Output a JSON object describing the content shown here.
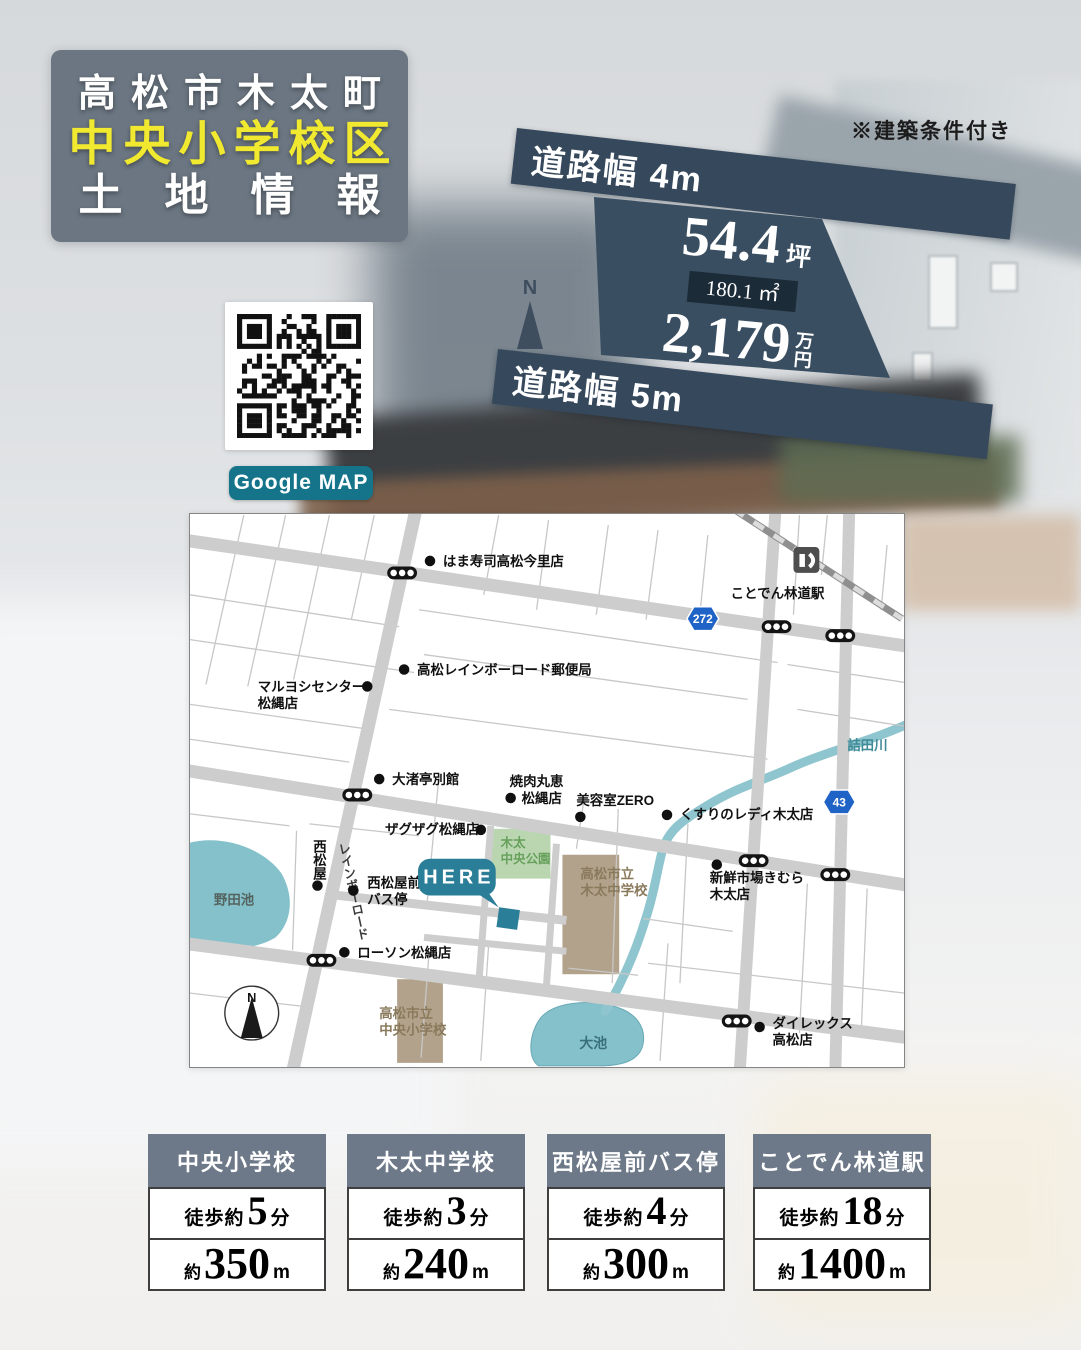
{
  "title_block": {
    "line1": "高松市木太町",
    "line2": "中央小学校区",
    "line3": "土地情報"
  },
  "note": "※建築条件付き",
  "banners": {
    "top": "道路幅 4m",
    "bottom": "道路幅 5m"
  },
  "parcel": {
    "tsubo": "54.4",
    "tsubo_unit": "坪",
    "area": "180.1 ㎡",
    "price": "2,179",
    "price_unit_top": "万",
    "price_unit_bottom": "円"
  },
  "compass_upper": {
    "label": "N"
  },
  "qr": {
    "caption": "Google MAP"
  },
  "map": {
    "compass_label": "N",
    "here_label": "HERE",
    "pois": [
      {
        "id": "hamazushi",
        "lines": [
          "はま寿司高松今里店"
        ],
        "x": 254,
        "y": 51,
        "dot": [
          241,
          46
        ]
      },
      {
        "id": "post-office",
        "lines": [
          "高松レインボーロード郵便局"
        ],
        "x": 228,
        "y": 160,
        "dot": [
          215,
          155
        ]
      },
      {
        "id": "maruyoshi",
        "lines": [
          "マルヨシセンター",
          "松縄店"
        ],
        "x": 68,
        "y": 177,
        "dot": [
          178,
          172
        ]
      },
      {
        "id": "onagitei",
        "lines": [
          "大渚亭別館"
        ],
        "x": 203,
        "y": 270,
        "dot": [
          190,
          265
        ]
      },
      {
        "id": "kotoden-rindo-station",
        "lines": [
          "ことでん林道駅"
        ],
        "x": 590,
        "y": 83,
        "anchor": "middle"
      },
      {
        "id": "yakiniku-marue",
        "lines": [
          "焼肉丸恵"
        ],
        "x": 321,
        "y": 272
      },
      {
        "id": "yakiniku-marue-2",
        "lines": [
          "松縄店"
        ],
        "x": 333,
        "y": 289,
        "dot": [
          322,
          284
        ]
      },
      {
        "id": "biyoshitsu-zero",
        "lines": [
          "美容室ZERO"
        ],
        "x": 388,
        "y": 291,
        "dot": [
          392,
          303
        ]
      },
      {
        "id": "kusuri-no-lady",
        "lines": [
          "くすりのレディ木太店"
        ],
        "x": 492,
        "y": 305,
        "dot": [
          479,
          301
        ]
      },
      {
        "id": "zagzag",
        "lines": [
          "ザグザグ松縄店"
        ],
        "x": 196,
        "y": 320,
        "dot": [
          292,
          316
        ]
      },
      {
        "id": "kimura-market",
        "lines": [
          "新鮮市場きむら",
          "木太店"
        ],
        "x": 522,
        "y": 369,
        "dot": [
          529,
          351
        ]
      },
      {
        "id": "nishimatsuya",
        "lines": [
          "西松屋"
        ],
        "x": 129,
        "y": 326,
        "dot": [
          128,
          372
        ],
        "vertical": true
      },
      {
        "id": "rainbow-road",
        "lines": [
          "レインボーロード"
        ],
        "x": 153,
        "y": 329,
        "vertical": true,
        "color": "#3c3c3c",
        "size": 12.5,
        "transform": "rotate(-12 153 329)"
      },
      {
        "id": "bus-stop",
        "lines": [
          "西松屋前",
          "バス停"
        ],
        "x": 178,
        "y": 374,
        "dot": [
          164,
          377
        ]
      },
      {
        "id": "lawson",
        "lines": [
          "ローソン松縄店"
        ],
        "x": 168,
        "y": 444,
        "dot": [
          155,
          439
        ]
      },
      {
        "id": "dairex",
        "lines": [
          "ダイレックス",
          "高松店"
        ],
        "x": 585,
        "y": 515,
        "dot": [
          572,
          514
        ]
      },
      {
        "id": "tsumeta-river",
        "lines": [
          "詰田川"
        ],
        "x": 660,
        "y": 236,
        "color": "#3f8b98"
      },
      {
        "id": "oike-pond",
        "lines": [
          "大池"
        ],
        "x": 391,
        "y": 535,
        "color": "#39707c",
        "size": 14
      },
      {
        "id": "noda-pond",
        "lines": [
          "野田池"
        ],
        "x": 24,
        "y": 391,
        "color": "#55635f"
      },
      {
        "id": "kita-chuo-park",
        "lines": [
          "木太",
          "中央公園"
        ],
        "x": 312,
        "y": 333,
        "color": "#67a05b",
        "size": 12.5
      },
      {
        "id": "kita-junior-high",
        "lines": [
          "高松市立",
          "木太中学校"
        ],
        "x": 392,
        "y": 365,
        "color": "#8a7a5c"
      },
      {
        "id": "chuo-elementary",
        "lines": [
          "高松市立",
          "中央小学校"
        ],
        "x": 190,
        "y": 505,
        "color": "#8a7a5c"
      }
    ],
    "traffic_lights": [
      [
        213,
        58
      ],
      [
        589,
        112
      ],
      [
        653,
        121
      ],
      [
        168,
        281
      ],
      [
        566,
        347
      ],
      [
        648,
        361
      ],
      [
        132,
        447
      ],
      [
        549,
        508
      ]
    ],
    "route_shields": [
      {
        "num": "272",
        "x": 515,
        "y": 104
      },
      {
        "num": "43",
        "x": 652,
        "y": 288
      }
    ]
  },
  "info_boxes": [
    {
      "title": "中央小学校",
      "walk_prefix": "徒歩約",
      "minutes": "5",
      "minutes_unit": "分",
      "dist_prefix": "約",
      "distance": "350",
      "distance_unit": "m"
    },
    {
      "title": "木太中学校",
      "walk_prefix": "徒歩約",
      "minutes": "3",
      "minutes_unit": "分",
      "dist_prefix": "約",
      "distance": "240",
      "distance_unit": "m"
    },
    {
      "title": "西松屋前バス停",
      "walk_prefix": "徒歩約",
      "minutes": "4",
      "minutes_unit": "分",
      "dist_prefix": "約",
      "distance": "300",
      "distance_unit": "m"
    },
    {
      "title": "ことでん林道駅",
      "walk_prefix": "徒歩約",
      "minutes": "18",
      "minutes_unit": "分",
      "dist_prefix": "約",
      "distance": "1400",
      "distance_unit": "m"
    }
  ],
  "colors": {
    "slate_title": "#6b7682",
    "slate_header": "#6d7988",
    "dark_navy": "#36495c",
    "dark_box": "#1c2b38",
    "teal_button": "#16748a",
    "teal_here": "#2b7e97",
    "yellow": "#f0e92f",
    "road": "#cdcdcd",
    "thin_road": "#c7c7c7",
    "water": "#85c1cb",
    "park": "#b9d6b1",
    "building": "#b2a28b",
    "rail": "#8f8f8f",
    "shield_blue": "#2063c6"
  }
}
